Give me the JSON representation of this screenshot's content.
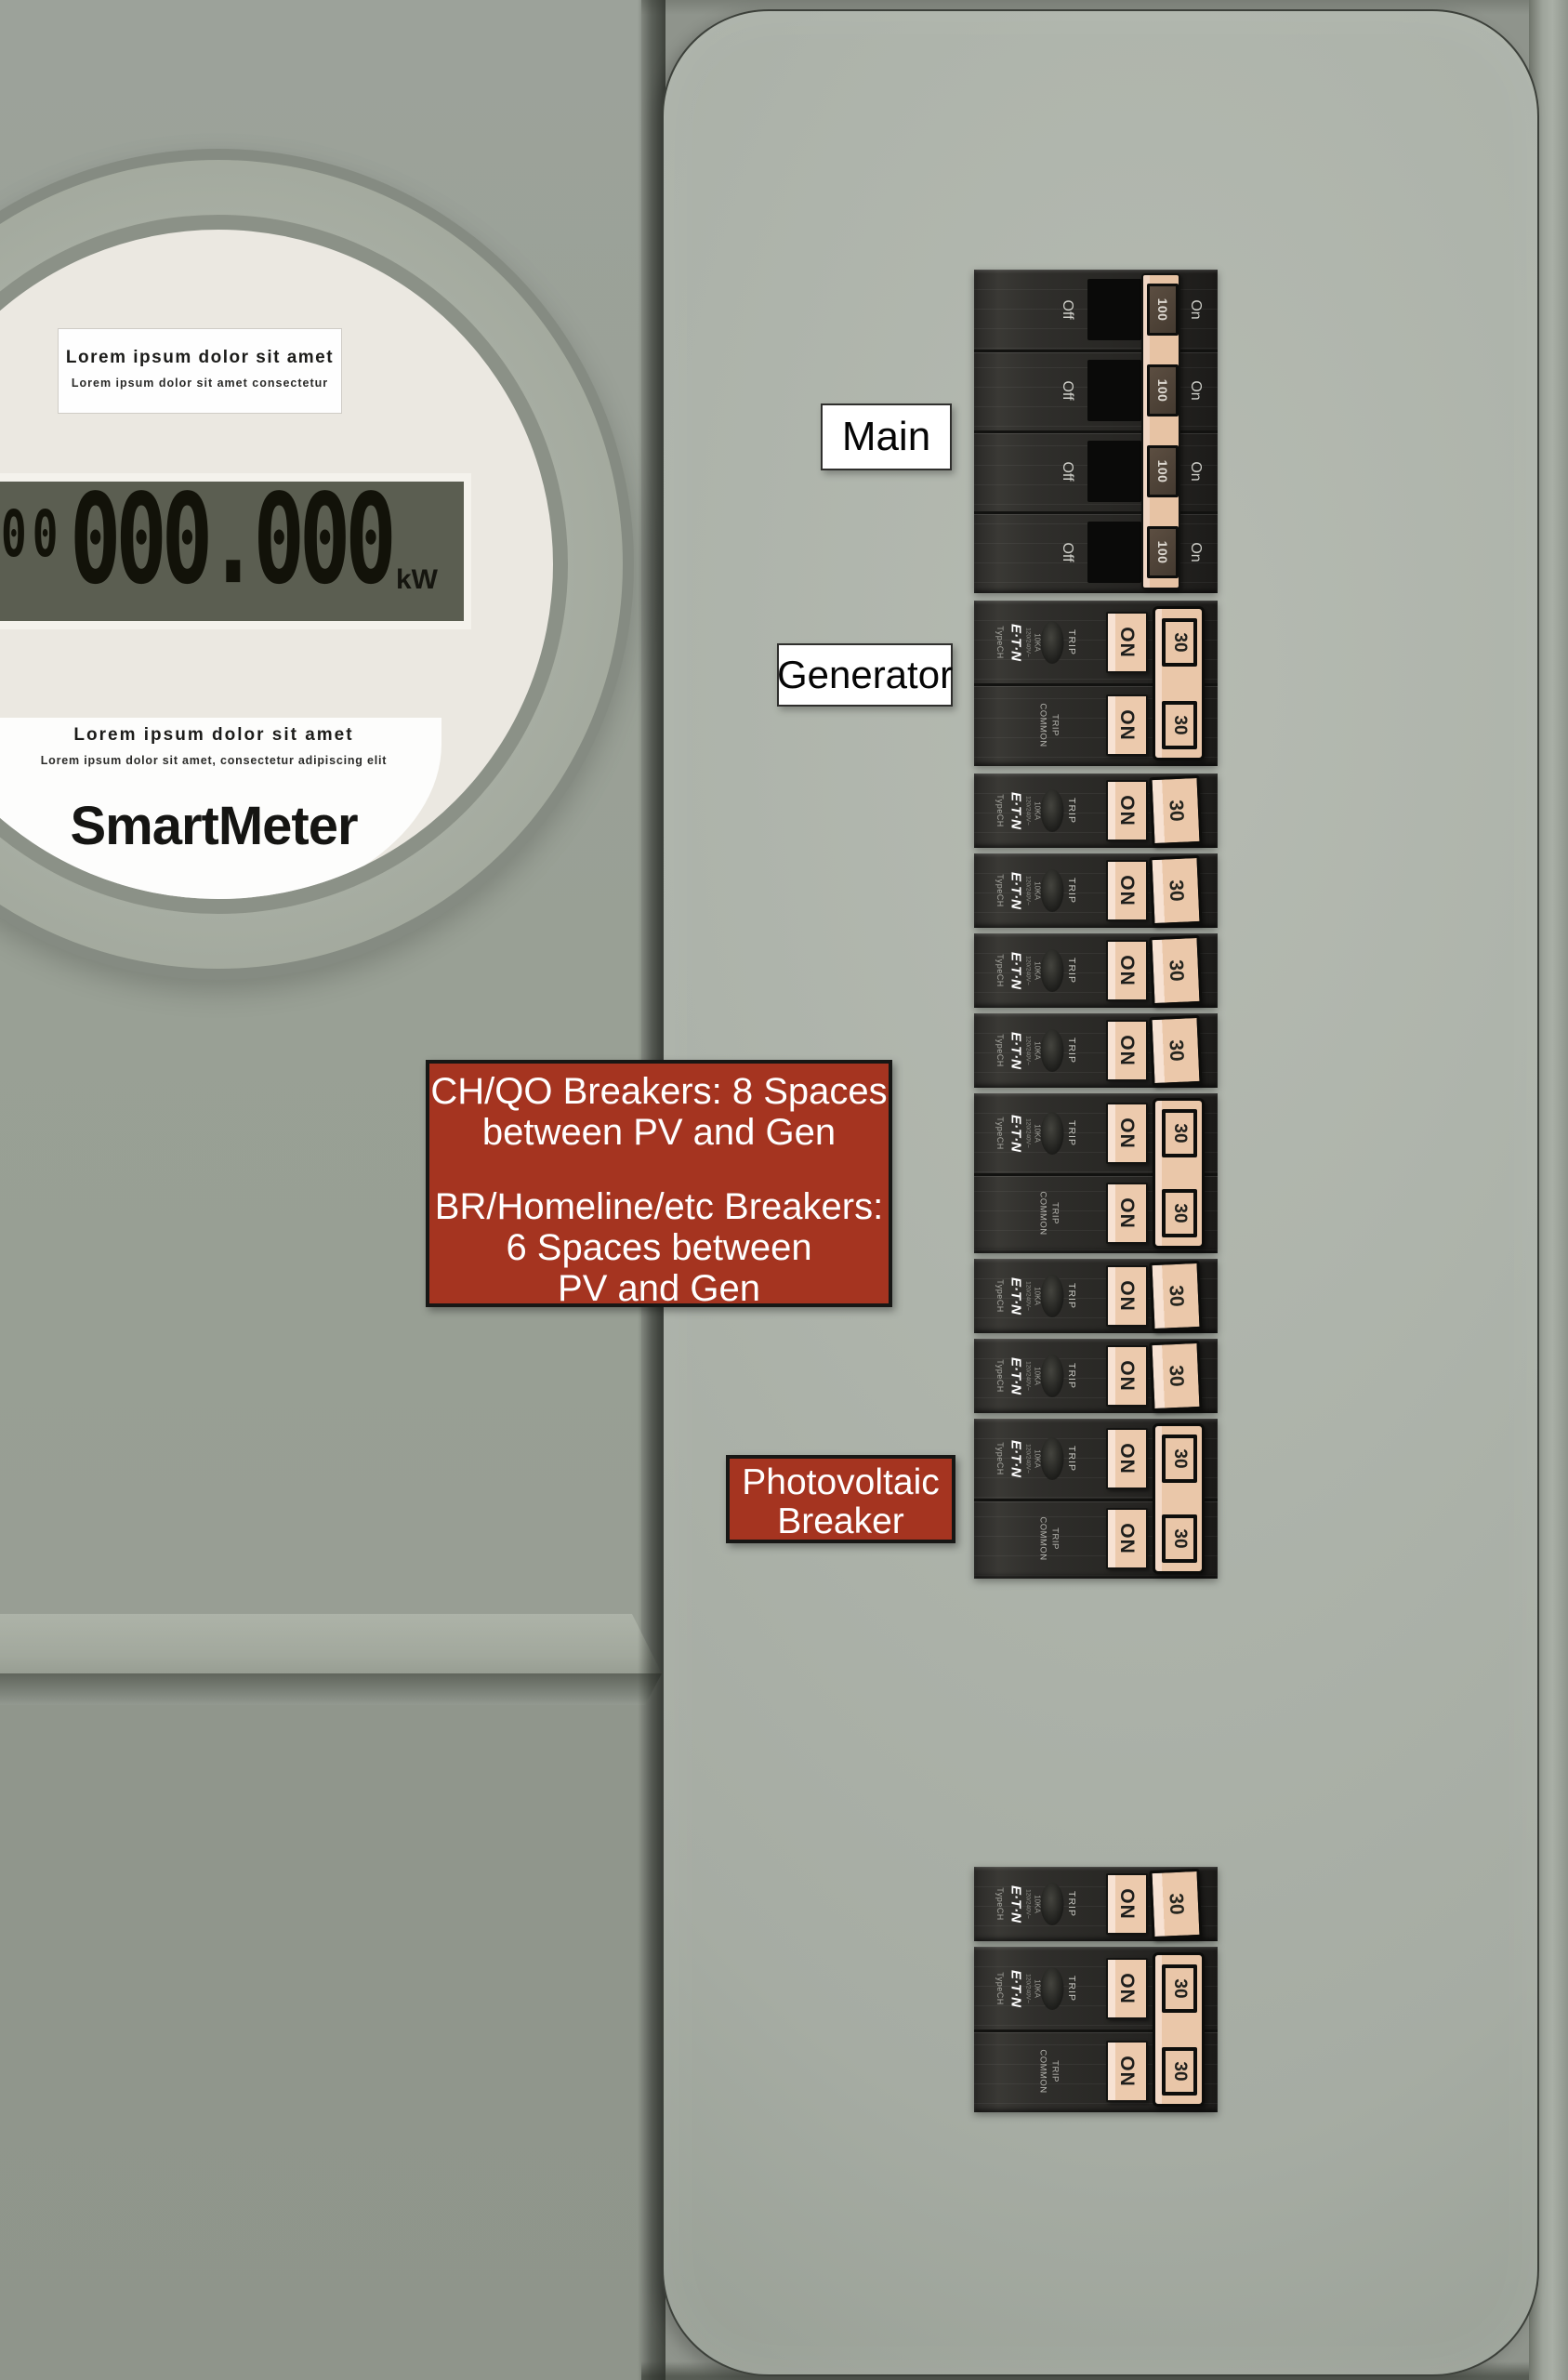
{
  "meter": {
    "top_label": {
      "title": "Lorem ipsum dolor sit amet",
      "subtitle": "Lorem ipsum dolor sit amet consectetur"
    },
    "display": {
      "small_digits": "00",
      "digits": "000.000",
      "unit": "kW"
    },
    "bottom_label": {
      "title": "Lorem ipsum dolor sit amet",
      "subtitle": "Lorem ipsum dolor sit amet, consectetur adipiscing elit",
      "brand": "SmartMeter"
    }
  },
  "panel_labels": {
    "main": "Main",
    "generator": "Generator",
    "photovoltaic_line1": "Photovoltaic",
    "photovoltaic_line2": "Breaker",
    "note": {
      "line1": "CH/QO Breakers: 8 Spaces",
      "line2": "between PV and Gen",
      "line3": "BR/Homeline/etc Breakers:",
      "line4": "6 Spaces between",
      "line5": "PV and Gen"
    }
  },
  "breaker_text": {
    "off": "Off",
    "on_small": "On",
    "main_amps": "100",
    "on": "ON",
    "branch_amps": "30",
    "trip": "TRIP",
    "common": "COMMON",
    "common_trip_word": "TRIP",
    "brand": "E·T·N",
    "type": "TypeCH",
    "voltage": "120/240V~",
    "interrupt": "10KA"
  },
  "colors": {
    "handle_tan": "#ecc9ab",
    "note_red": "#a53420",
    "breaker_body": "#2b2a27",
    "door_gray": "#adb3aa",
    "lcd_olive": "#5b5e51"
  }
}
